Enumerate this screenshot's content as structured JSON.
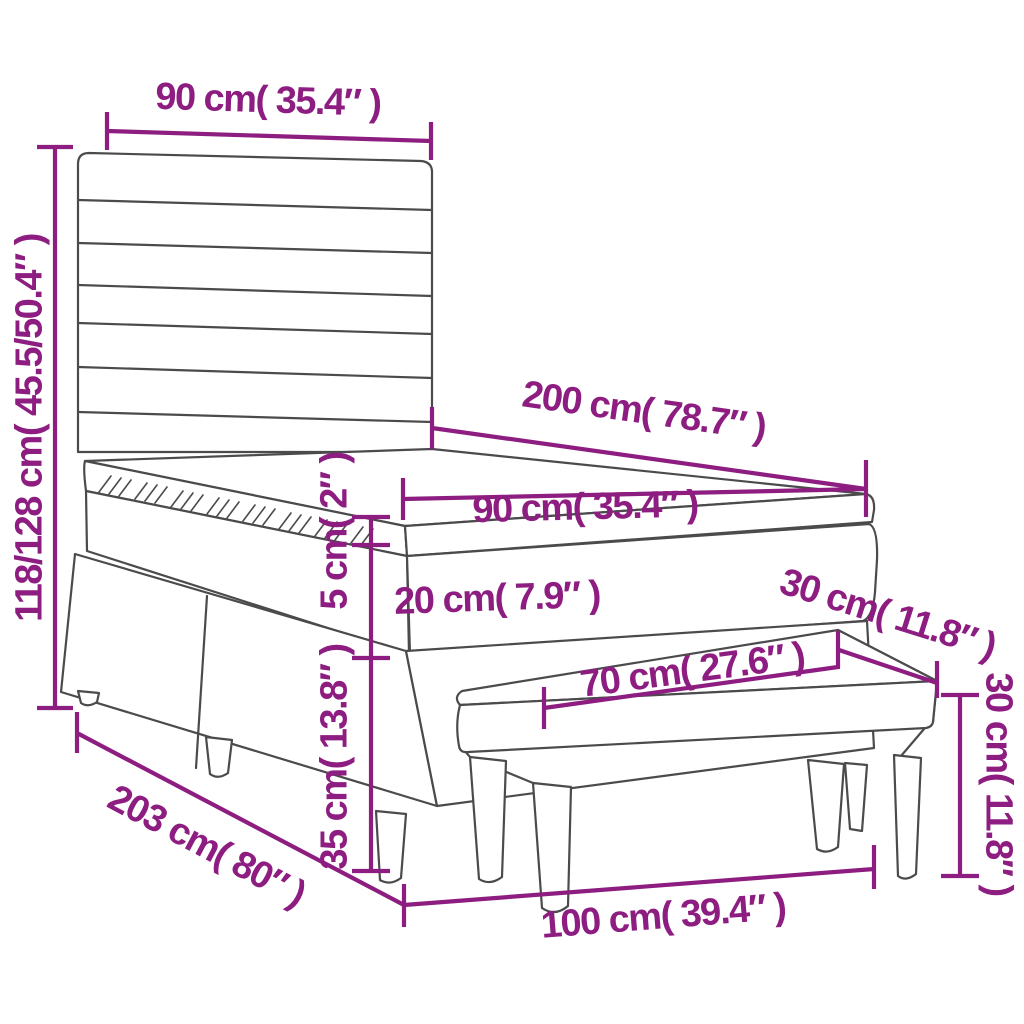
{
  "diagram": {
    "title": "box-spring-bed-with-headboard-and-bench-dimension-diagram",
    "colors": {
      "accent": "#8D1D80",
      "line": "#4B4B4D",
      "background": "#FFFFFF"
    },
    "labels": {
      "headboard_width": "90 cm( 35.4″ )",
      "overall_height": "118/128 cm( 45.5/50.4″ )",
      "bed_length": "200 cm( 78.7″ )",
      "mattress_width": "90 cm( 35.4″ )",
      "topper_thickness": "5 cm( 2″ )",
      "mattress_thickness": "20 cm( 7.9″ )",
      "base_height": "35 cm( 13.8″ )",
      "bench_depth": "30 cm( 11.8″ )",
      "bench_seat_length": "70 cm( 27.6″ )",
      "bench_height": "30 cm( 11.8″ )",
      "frame_length": "203 cm( 80″ )",
      "bench_length": "100 cm( 39.4″ )"
    }
  }
}
